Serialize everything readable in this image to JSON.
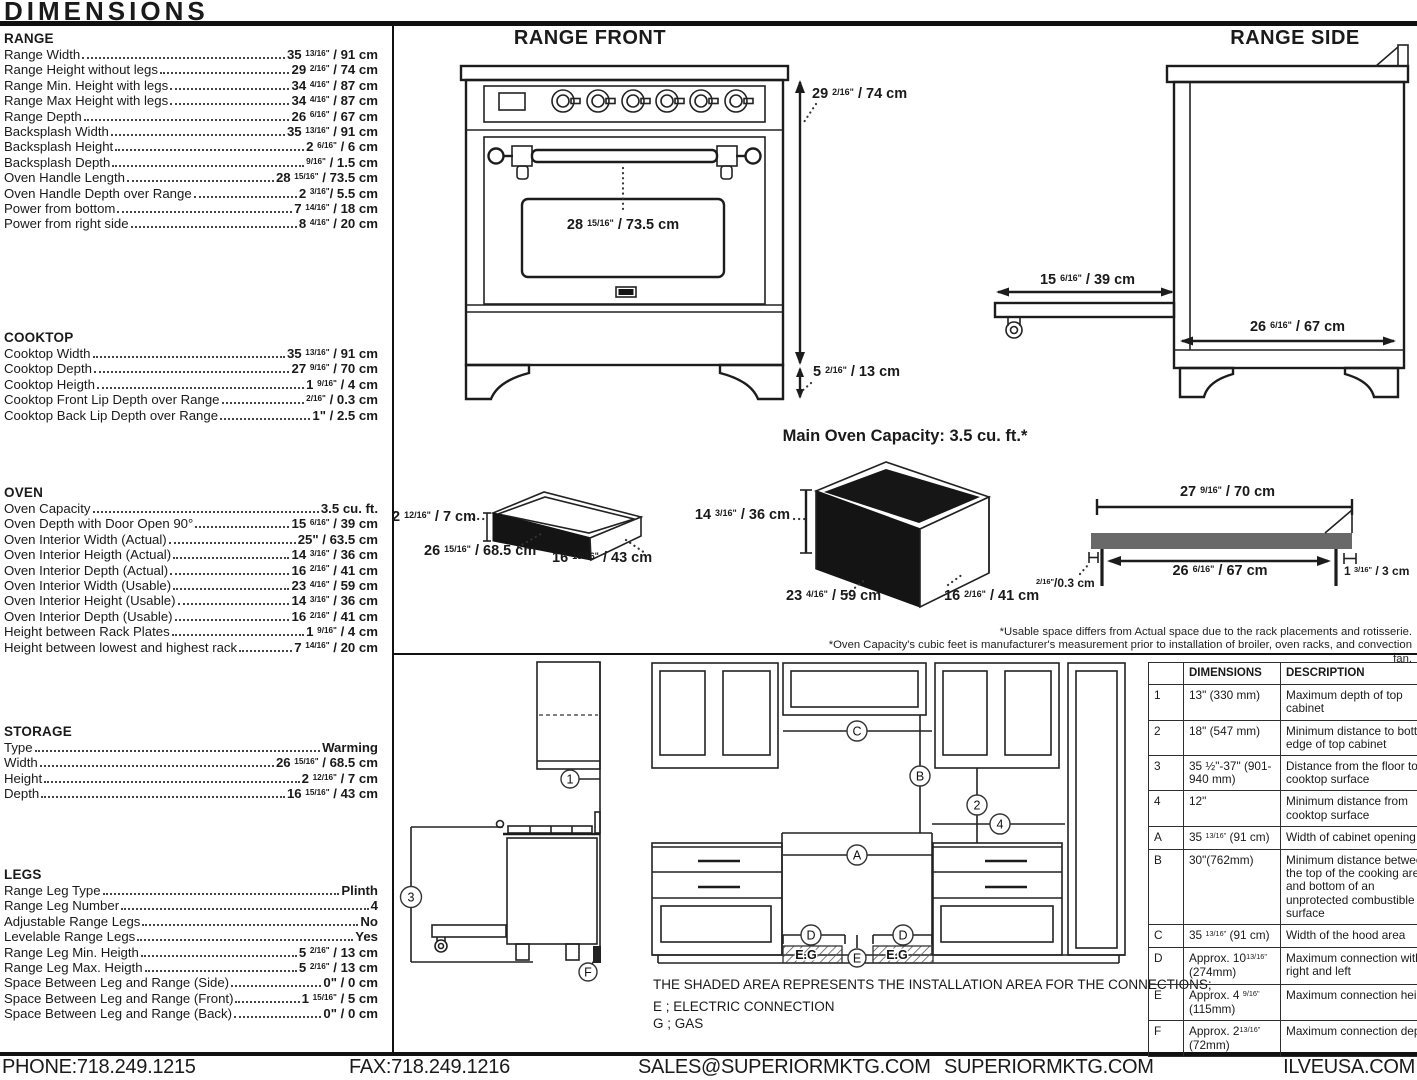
{
  "title": "DIMENSIONS",
  "specs": [
    {
      "name": "RANGE",
      "rows": [
        {
          "l": "Range Width",
          "v": "35 {13/16\"} / 91 cm"
        },
        {
          "l": "Range Height without legs",
          "v": "29 {2/16\"} / 74 cm"
        },
        {
          "l": "Range Min. Height with legs",
          "v": "34 {4/16\"} / 87 cm"
        },
        {
          "l": "Range Max Height with legs",
          "v": "34 {4/16\"} / 87 cm"
        },
        {
          "l": "Range Depth",
          "v": "26 {6/16\"} / 67 cm"
        },
        {
          "l": "Backsplash Width",
          "v": "35 {13/16\"} / 91 cm"
        },
        {
          "l": "Backsplash Height",
          "v": "2 {6/16\"} / 6 cm"
        },
        {
          "l": "Backsplash Depth",
          "v": "{9/16\"} / 1.5 cm"
        },
        {
          "l": "Oven Handle Length",
          "v": "28 {15/16\"} / 73.5 cm"
        },
        {
          "l": "Oven Handle Depth over Range",
          "v": "2 {3/16\"}/ 5.5 cm"
        },
        {
          "l": "Power from bottom",
          "v": "7 {14/16\"} / 18 cm"
        },
        {
          "l": "Power from right side",
          "v": "8 {4/16\"} / 20 cm"
        }
      ]
    },
    {
      "name": "COOKTOP",
      "rows": [
        {
          "l": "Cooktop Width",
          "v": "35 {13/16\"} / 91 cm"
        },
        {
          "l": "Cooktop Depth",
          "v": "27 {9/16\"} / 70 cm"
        },
        {
          "l": "Cooktop Heigth",
          "v": "1 {9/16\"} / 4 cm"
        },
        {
          "l": "Cooktop Front Lip Depth over Range",
          "v": "{2/16\"} / 0.3 cm"
        },
        {
          "l": "Cooktop Back Lip Depth over Range",
          "v": "1\" / 2.5 cm"
        }
      ]
    },
    {
      "name": "OVEN",
      "rows": [
        {
          "l": "Oven Capacity",
          "v": "3.5 cu. ft."
        },
        {
          "l": "Oven Depth with Door Open 90°",
          "v": "15 {6/16\"} / 39 cm"
        },
        {
          "l": "Oven Interior Width (Actual)",
          "v": "25\" / 63.5 cm"
        },
        {
          "l": "Oven Interior Heigth (Actual)",
          "v": "14 {3/16\"} / 36 cm"
        },
        {
          "l": "Oven Interior Depth (Actual)",
          "v": "16 {2/16\"} / 41 cm"
        },
        {
          "l": "Oven Interior Width (Usable)",
          "v": "23 {4/16\"} / 59 cm"
        },
        {
          "l": "Oven Interior Height (Usable)",
          "v": "14 {3/16\"} / 36 cm"
        },
        {
          "l": "Oven Interior Depth (Usable)",
          "v": "16 {2/16\"} / 41 cm"
        },
        {
          "l": "Height between Rack Plates",
          "v": "1 {9/16\"} / 4 cm"
        },
        {
          "l": "Height between lowest and highest rack",
          "v": "7 {14/16\"} / 20 cm"
        }
      ]
    },
    {
      "name": "STORAGE",
      "rows": [
        {
          "l": "Type",
          "v": "Warming"
        },
        {
          "l": "Width",
          "v": "26 {15/16\"} / 68.5 cm"
        },
        {
          "l": "Height",
          "v": "2 {12/16\"} / 7 cm"
        },
        {
          "l": "Depth",
          "v": "16 {15/16\"} / 43 cm"
        }
      ]
    },
    {
      "name": "LEGS",
      "rows": [
        {
          "l": "Range Leg Type",
          "v": "Plinth"
        },
        {
          "l": "Range Leg Number",
          "v": "4"
        },
        {
          "l": "Adjustable Range Legs",
          "v": "No"
        },
        {
          "l": "Levelable Range Legs",
          "v": "Yes"
        },
        {
          "l": "Range Leg Min. Heigth",
          "v": "5 {2/16\"} / 13 cm"
        },
        {
          "l": "Range Leg Max. Heigth",
          "v": "5 {2/16\"} / 13 cm"
        },
        {
          "l": "Space Between Leg and Range (Side)",
          "v": "0\" / 0 cm"
        },
        {
          "l": "Space Between Leg and Range (Front)",
          "v": "1 {15/16\"} / 5 cm"
        },
        {
          "l": "Space Between Leg and Range (Back)",
          "v": "0\" / 0 cm"
        }
      ]
    }
  ],
  "drawings": {
    "range_front": {
      "title": "RANGE FRONT",
      "dim_height": "29 {2/16\"} / 74 cm",
      "dim_handle": "28 {15/16\"} / 73.5 cm",
      "dim_leg": "5 {2/16\"} / 13 cm"
    },
    "range_side": {
      "title": "RANGE SIDE",
      "dim_door": "15 {6/16\"} / 39 cm",
      "dim_depth": "26 {6/16\"} / 67 cm"
    },
    "capacity_title": "Main Oven Capacity: 3.5 cu. ft.*",
    "drawer_box": {
      "h": "2 {12/16\"} / 7 cm",
      "w": "26 {15/16\"} / 68.5 cm",
      "d": "16 {15/16\"} / 43 cm"
    },
    "oven_box": {
      "h": "14 {3/16\"} / 36 cm",
      "w": "23 {4/16\"} / 59 cm",
      "d": "16 {2/16\"} / 41 cm"
    },
    "cooktop_profile": {
      "top": "27 {9/16\"} / 70 cm",
      "inner": "26 {6/16\"} / 67 cm",
      "front_lip": "{2/16\"}/0.3 cm",
      "back_lip": "1 {3/16\"} / 3 cm"
    },
    "footnote1": "*Usable space differs from Actual space due to the rack placements and rotisserie.",
    "footnote2": "*Oven Capacity's cubic feet is manufacturer's measurement prior to installation of broiler, oven racks, and convection fan."
  },
  "install": {
    "markers": {
      "n1": "1",
      "n2": "2",
      "n3": "3",
      "n4": "4",
      "A": "A",
      "B": "B",
      "C": "C",
      "D": "D",
      "E": "E",
      "F": "F"
    },
    "eg_label": "E.G",
    "shaded_note": "THE SHADED AREA REPRESENTS THE INSTALLATION AREA FOR THE CONNECTIONS;",
    "electric_note": "E ; ELECTRIC CONNECTION",
    "gas_note": "G ; GAS"
  },
  "table": {
    "headers": [
      "",
      "DIMENSIONS",
      "DESCRIPTION"
    ],
    "rows": [
      {
        "id": "1",
        "dim": "13\" (330 mm)",
        "desc": "Maximum depth of top cabinet"
      },
      {
        "id": "2",
        "dim": "18\" (547 mm)",
        "desc": "Minimum distance to bottom edge of top cabinet"
      },
      {
        "id": "3",
        "dim": "35 ½\"-37\" (901-940 mm)",
        "desc": "Distance from the floor to cooktop surface"
      },
      {
        "id": "4",
        "dim": "12\"",
        "desc": "Minimum distance from cooktop surface"
      },
      {
        "id": "A",
        "dim": "35 {13/16\"} (91 cm)",
        "desc": "Width of cabinet opening"
      },
      {
        "id": "B",
        "dim": "30\"(762mm)",
        "desc": "Minimum distance between the top of the cooking area and bottom of an unprotected combustible surface"
      },
      {
        "id": "C",
        "dim": "35 {13/16\"} (91 cm)",
        "desc": "Width of the hood area"
      },
      {
        "id": "D",
        "dim": "Approx. 10{13/16\"} (274mm)",
        "desc": "Maximum connection with right and left"
      },
      {
        "id": "E",
        "dim": "Approx. 4 {9/16\"} (115mm)",
        "desc": "Maximum connection height"
      },
      {
        "id": "F",
        "dim": "Approx. 2{13/16\"} (72mm)",
        "desc": "Maximum connection depth"
      }
    ]
  },
  "footer": {
    "phone": "PHONE:718.249.1215",
    "fax": "FAX:718.249.1216",
    "sales": "SALES@SUPERIORMKTG.COM",
    "site1": "SUPERIORMKTG.COM",
    "site2": "ILVEUSA.COM"
  }
}
